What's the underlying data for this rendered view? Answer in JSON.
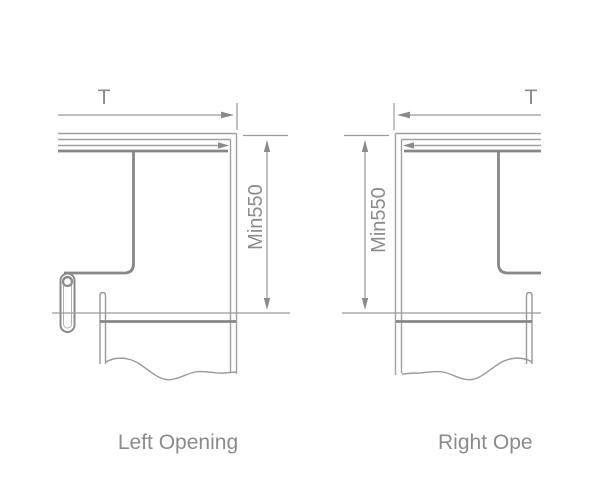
{
  "figure": {
    "background": "#ffffff",
    "thin_line_color": "#a0a0a0",
    "dark_line_color": "#878787",
    "text_color": "#8b8b8b"
  },
  "left_diagram": {
    "caption": "Left Opening",
    "width_dimension_label": "T",
    "height_dimension_label": "Min550"
  },
  "right_diagram": {
    "caption": "Right Ope",
    "width_dimension_label": "T",
    "height_dimension_label": "Min550"
  }
}
